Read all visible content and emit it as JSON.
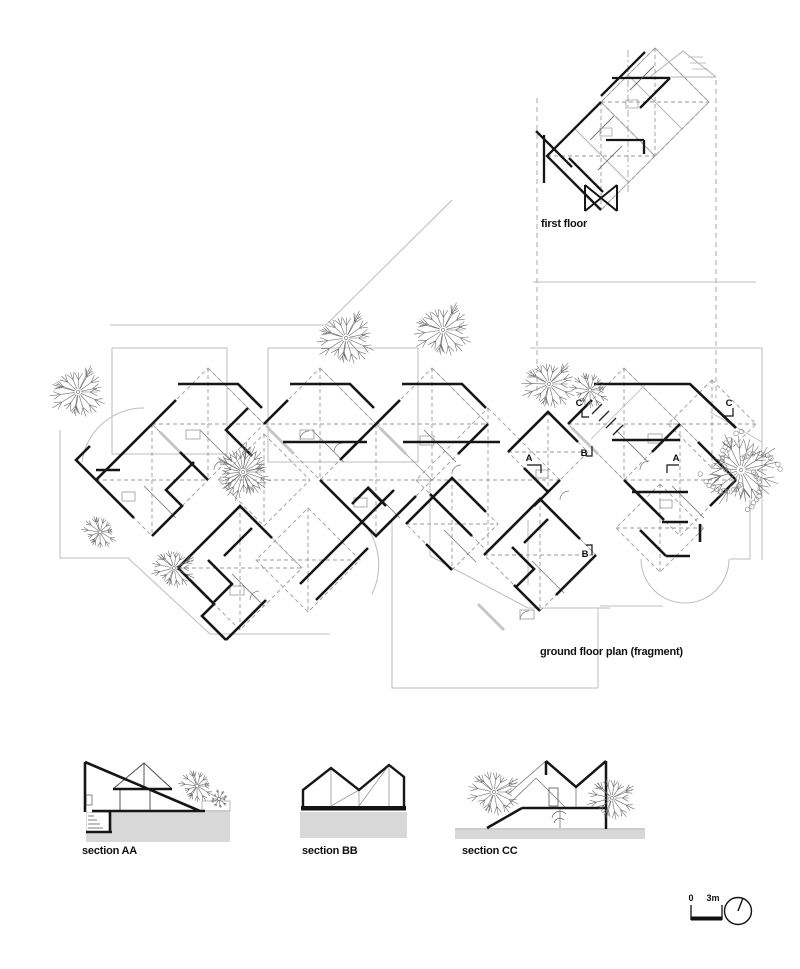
{
  "labels": {
    "first_floor": "first floor",
    "ground_floor": "ground floor plan (fragment)",
    "section_aa": "section AA",
    "section_bb": "section BB",
    "section_cc": "section CC"
  },
  "markers": {
    "a_left": "A",
    "a_right": "A",
    "b_top": "B",
    "b_bottom": "B",
    "c_left": "C",
    "c_right": "C"
  },
  "scale_bar": {
    "zero": "0",
    "three_m": "3m"
  },
  "colors": {
    "wall": "#161616",
    "site_line": "#bcbcbc",
    "dashed_line": "#9a9a9a",
    "ground_fill": "#d8d8d8",
    "text": "#111111"
  }
}
